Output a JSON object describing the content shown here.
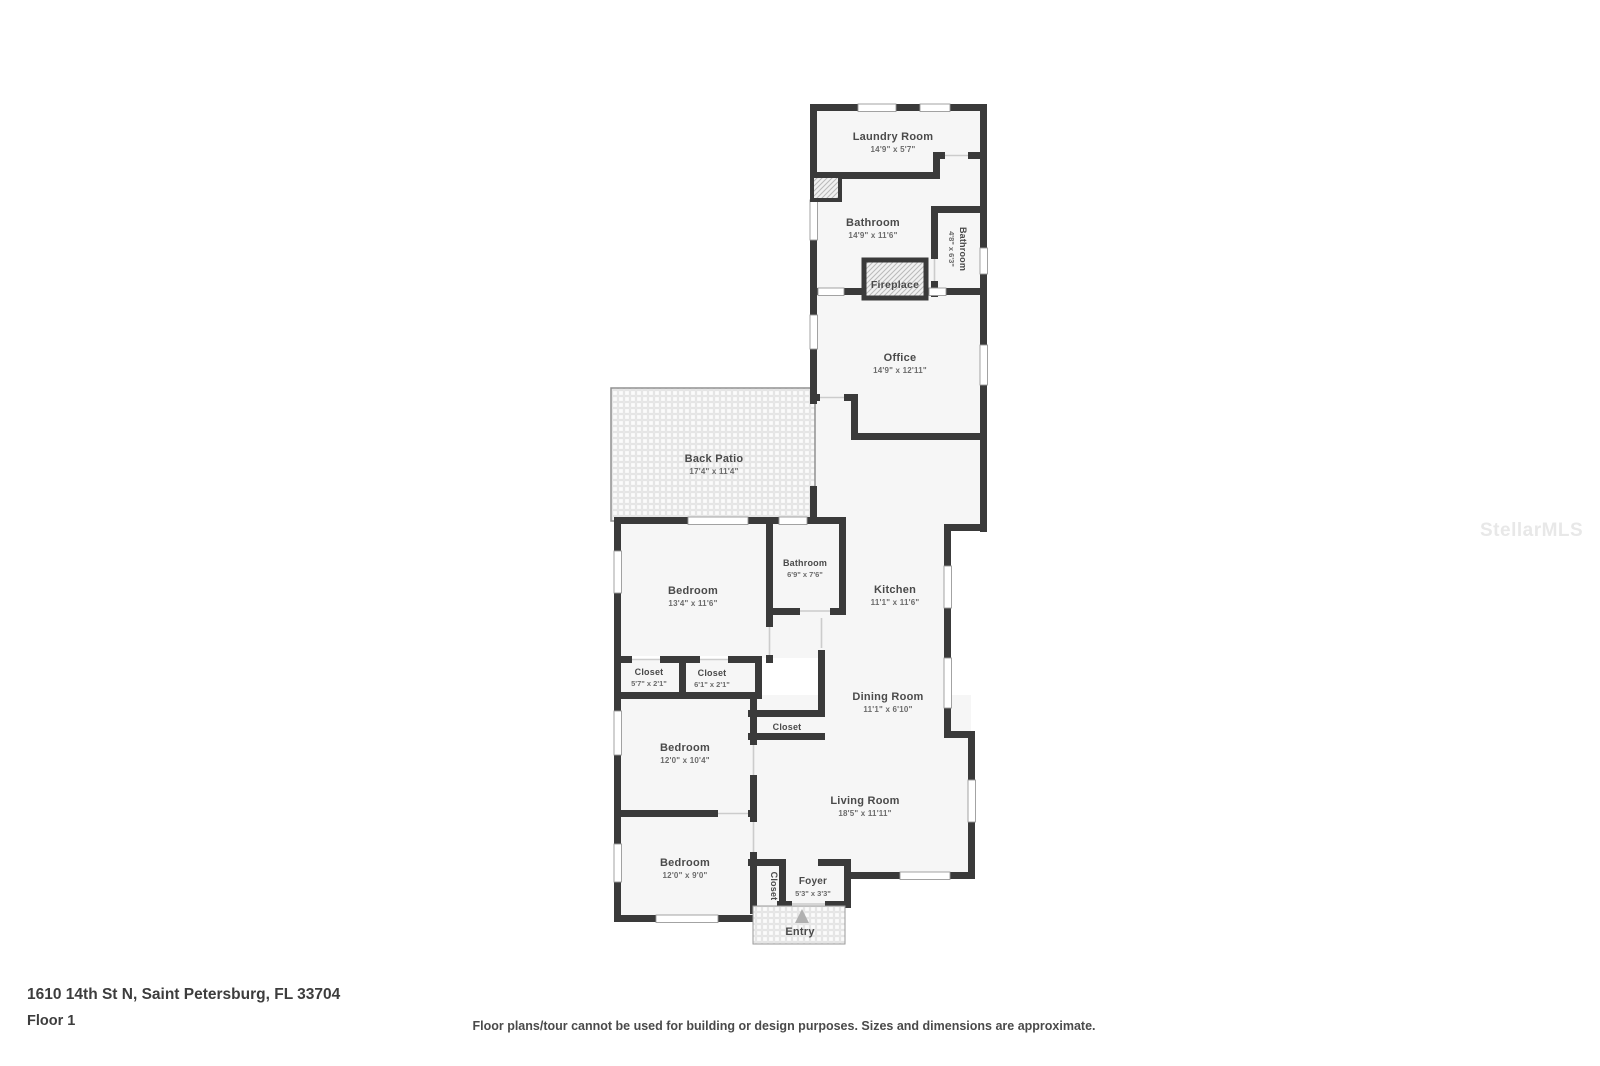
{
  "watermark": "StellarMLS",
  "footer": {
    "address": "1610 14th St N, Saint Petersburg, FL 33704",
    "floor_label": "Floor 1",
    "disclaimer": "Floor plans/tour cannot be used for building or design purposes. Sizes and dimensions are approximate."
  },
  "colors": {
    "wall": "#3a3a3a",
    "floor": "#f6f6f6",
    "background": "#ffffff",
    "room_name_text": "#4a4a4a",
    "room_dims_text": "#6b6b6b",
    "watermark_text": "#e8e8e8"
  },
  "rooms": [
    {
      "id": "laundry-room",
      "name": "Laundry Room",
      "dims": "14'9\" x 5'7\""
    },
    {
      "id": "bathroom-main",
      "name": "Bathroom",
      "dims": "14'9\" x 11'6\""
    },
    {
      "id": "bathroom-small",
      "name": "Bathroom",
      "dims": "4'8\" x 6'3\""
    },
    {
      "id": "fireplace",
      "name": "Fireplace",
      "dims": ""
    },
    {
      "id": "office",
      "name": "Office",
      "dims": "14'9\" x 12'11\""
    },
    {
      "id": "back-patio",
      "name": "Back Patio",
      "dims": "17'4\" x 11'4\""
    },
    {
      "id": "bedroom-1",
      "name": "Bedroom",
      "dims": "13'4\" x 11'6\""
    },
    {
      "id": "bathroom-hall",
      "name": "Bathroom",
      "dims": "6'9\" x 7'6\""
    },
    {
      "id": "kitchen",
      "name": "Kitchen",
      "dims": "11'1\" x 11'6\""
    },
    {
      "id": "closet-1",
      "name": "Closet",
      "dims": "5'7\" x 2'1\""
    },
    {
      "id": "closet-2",
      "name": "Closet",
      "dims": "6'1\" x 2'1\""
    },
    {
      "id": "dining-room",
      "name": "Dining Room",
      "dims": "11'1\" x 6'10\""
    },
    {
      "id": "closet-living",
      "name": "Closet",
      "dims": ""
    },
    {
      "id": "bedroom-2",
      "name": "Bedroom",
      "dims": "12'0\" x 10'4\""
    },
    {
      "id": "living-room",
      "name": "Living Room",
      "dims": "18'5\" x 11'11\""
    },
    {
      "id": "bedroom-3",
      "name": "Bedroom",
      "dims": "12'0\" x 9'0\""
    },
    {
      "id": "closet-foyer",
      "name": "Closet",
      "dims": ""
    },
    {
      "id": "foyer",
      "name": "Foyer",
      "dims": "5'3\" x 3'3\""
    },
    {
      "id": "entry",
      "name": "Entry",
      "dims": ""
    }
  ]
}
